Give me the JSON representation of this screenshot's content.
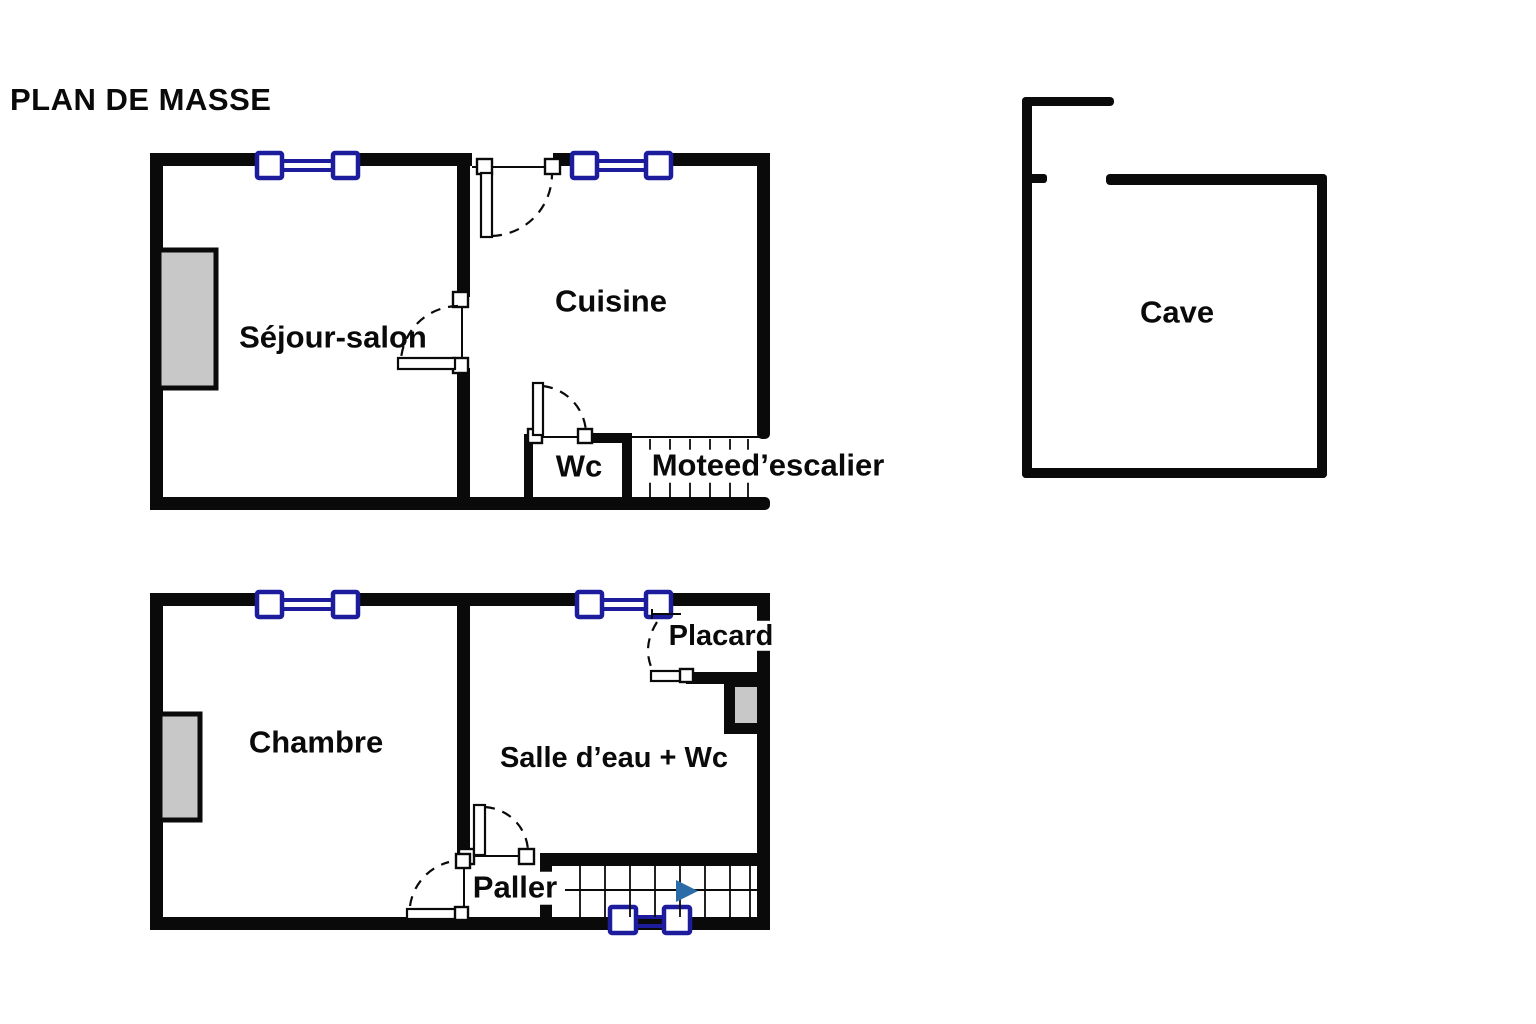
{
  "title": "PLAN DE MASSE",
  "colors": {
    "wall": "#0a0a0a",
    "window": "#1c1c9c",
    "gray": "#c8c8c8",
    "arrow": "#2b6ca8",
    "text": "#0a0a0a",
    "background": "#ffffff"
  },
  "plans": {
    "floor1": {
      "rooms": {
        "sejour": "Séjour-salon",
        "cuisine": "Cuisine",
        "wc": "Wc",
        "stair": "Moteed’escalier"
      }
    },
    "cave": {
      "rooms": {
        "cave": "Cave"
      }
    },
    "floor2": {
      "rooms": {
        "chambre": "Chambre",
        "salle_eau": "Salle d’eau + Wc",
        "placard": "Placard",
        "palier": "Paller"
      }
    }
  },
  "icons": {
    "window_symbol": "double-line-window-icon",
    "door_swing": "dashed-arc-door-icon",
    "stair_arrow": "stair-direction-arrow-icon"
  }
}
